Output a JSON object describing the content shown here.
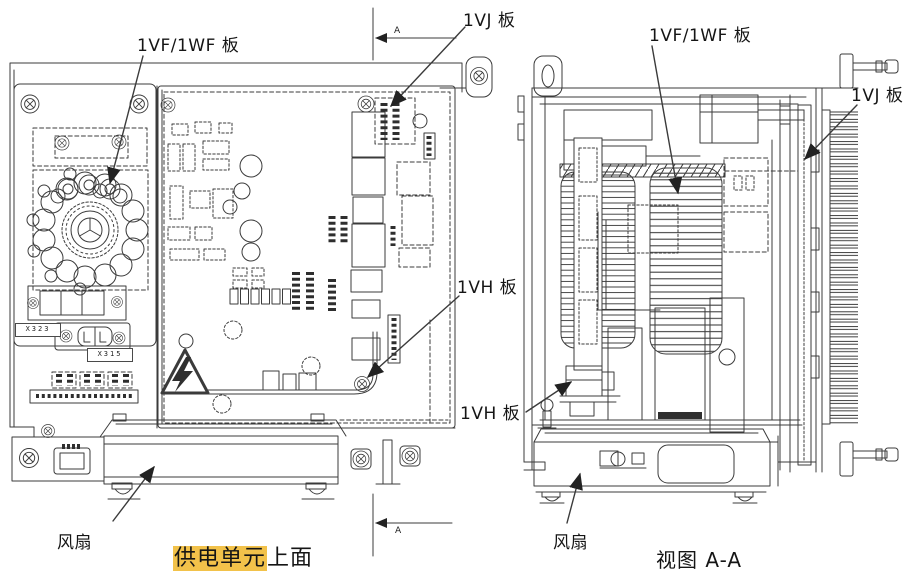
{
  "highlight_color": "#f2c24a",
  "left_view": {
    "board_label": "1VF/1WF 板",
    "vj_label": "1VJ 板",
    "vh_label": "1VH 板",
    "fan_label": "风扇",
    "caption_highlighted": "供电单元",
    "caption_plain": "上面",
    "connector_label_x323": "X323",
    "connector_label_x315": "X315",
    "section_marker_top": "A",
    "section_marker_bottom": "A"
  },
  "right_view": {
    "board_label": "1VF/1WF 板",
    "vj_label": "1VJ 板",
    "vh_label": "1VH 板",
    "fan_label": "风扇",
    "caption": "视图 A-A"
  }
}
